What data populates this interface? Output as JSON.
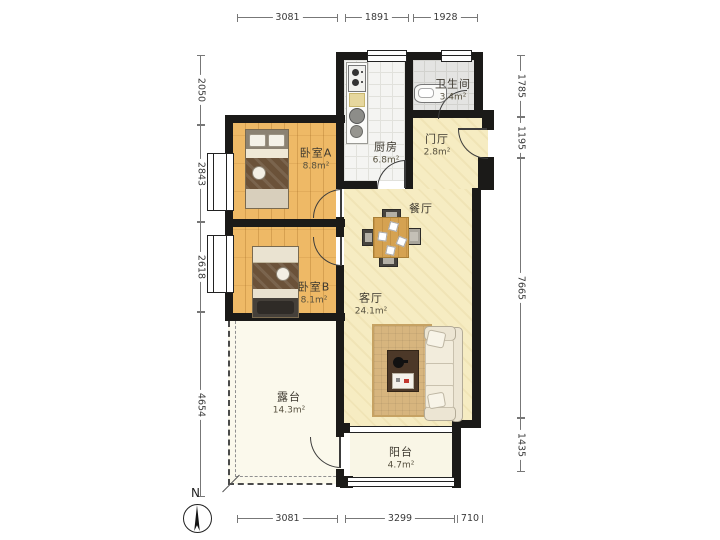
{
  "compass": {
    "label": "N"
  },
  "rooms": {
    "bedroom_a": {
      "name": "卧室A",
      "area": "8.8m²"
    },
    "bedroom_b": {
      "name": "卧室B",
      "area": "8.1m²"
    },
    "kitchen": {
      "name": "厨房",
      "area": "6.8m²"
    },
    "bathroom": {
      "name": "卫生间",
      "area": "3.4m²"
    },
    "foyer": {
      "name": "门厅",
      "area": "2.8m²"
    },
    "dining": {
      "name": "餐厅",
      "area": ""
    },
    "living": {
      "name": "客厅",
      "area": "24.1m²"
    },
    "terrace": {
      "name": "露台",
      "area": "14.3m²"
    },
    "balcony": {
      "name": "阳台",
      "area": "4.7m²"
    }
  },
  "dimensions": {
    "top": [
      {
        "value": "3081"
      },
      {
        "value": "1891"
      },
      {
        "value": "1928"
      }
    ],
    "bottom": [
      {
        "value": "3081"
      },
      {
        "value": "3299"
      },
      {
        "value": "710"
      }
    ],
    "left": [
      {
        "value": "2050"
      },
      {
        "value": "2843"
      },
      {
        "value": "2618"
      },
      {
        "value": "4654"
      }
    ],
    "right": [
      {
        "value": "1785"
      },
      {
        "value": "1195"
      },
      {
        "value": "7665"
      },
      {
        "value": "1435"
      }
    ]
  },
  "colors": {
    "wall": "#1b1a18",
    "wood_floor": "#eeb966",
    "living_floor": "#f6ecc2",
    "kitchen_floor": "#f4f4f2",
    "bath_floor": "#e4e4e2",
    "terrace_floor": "#fbf9ec",
    "balcony_floor": "#f9f6e6"
  }
}
